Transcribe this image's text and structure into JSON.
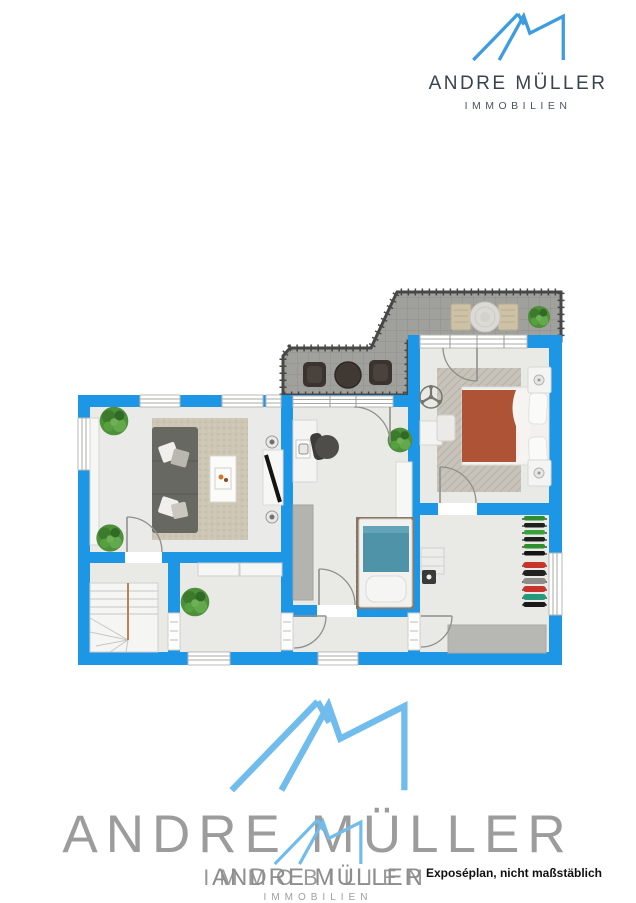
{
  "header": {
    "brand": "ANDRE MÜLLER",
    "tagline": "IMMOBILIEN"
  },
  "watermark": {
    "brand": "ANDRE MÜLLER",
    "tagline": "IMMOBILIEN"
  },
  "footnote": "Exposéplan, nicht maßstäblich",
  "colors": {
    "logo_blue": "#3d9ce1",
    "watermark_blue": "#70bcec",
    "wall_blue": "#1e96e6",
    "floor_gray": "#e9e9e6",
    "balcony_gray": "#a0a09c",
    "balcony_rail": "#474747",
    "bed_terracotta": "#ae5336",
    "bed_teal": "#4f93a8",
    "rug_beige": "#cdc6b5",
    "rug_brown": "#8a7662",
    "header_text": "#39434f",
    "watermark_gray": "#9c9c9c",
    "footnote_text": "#101010"
  }
}
